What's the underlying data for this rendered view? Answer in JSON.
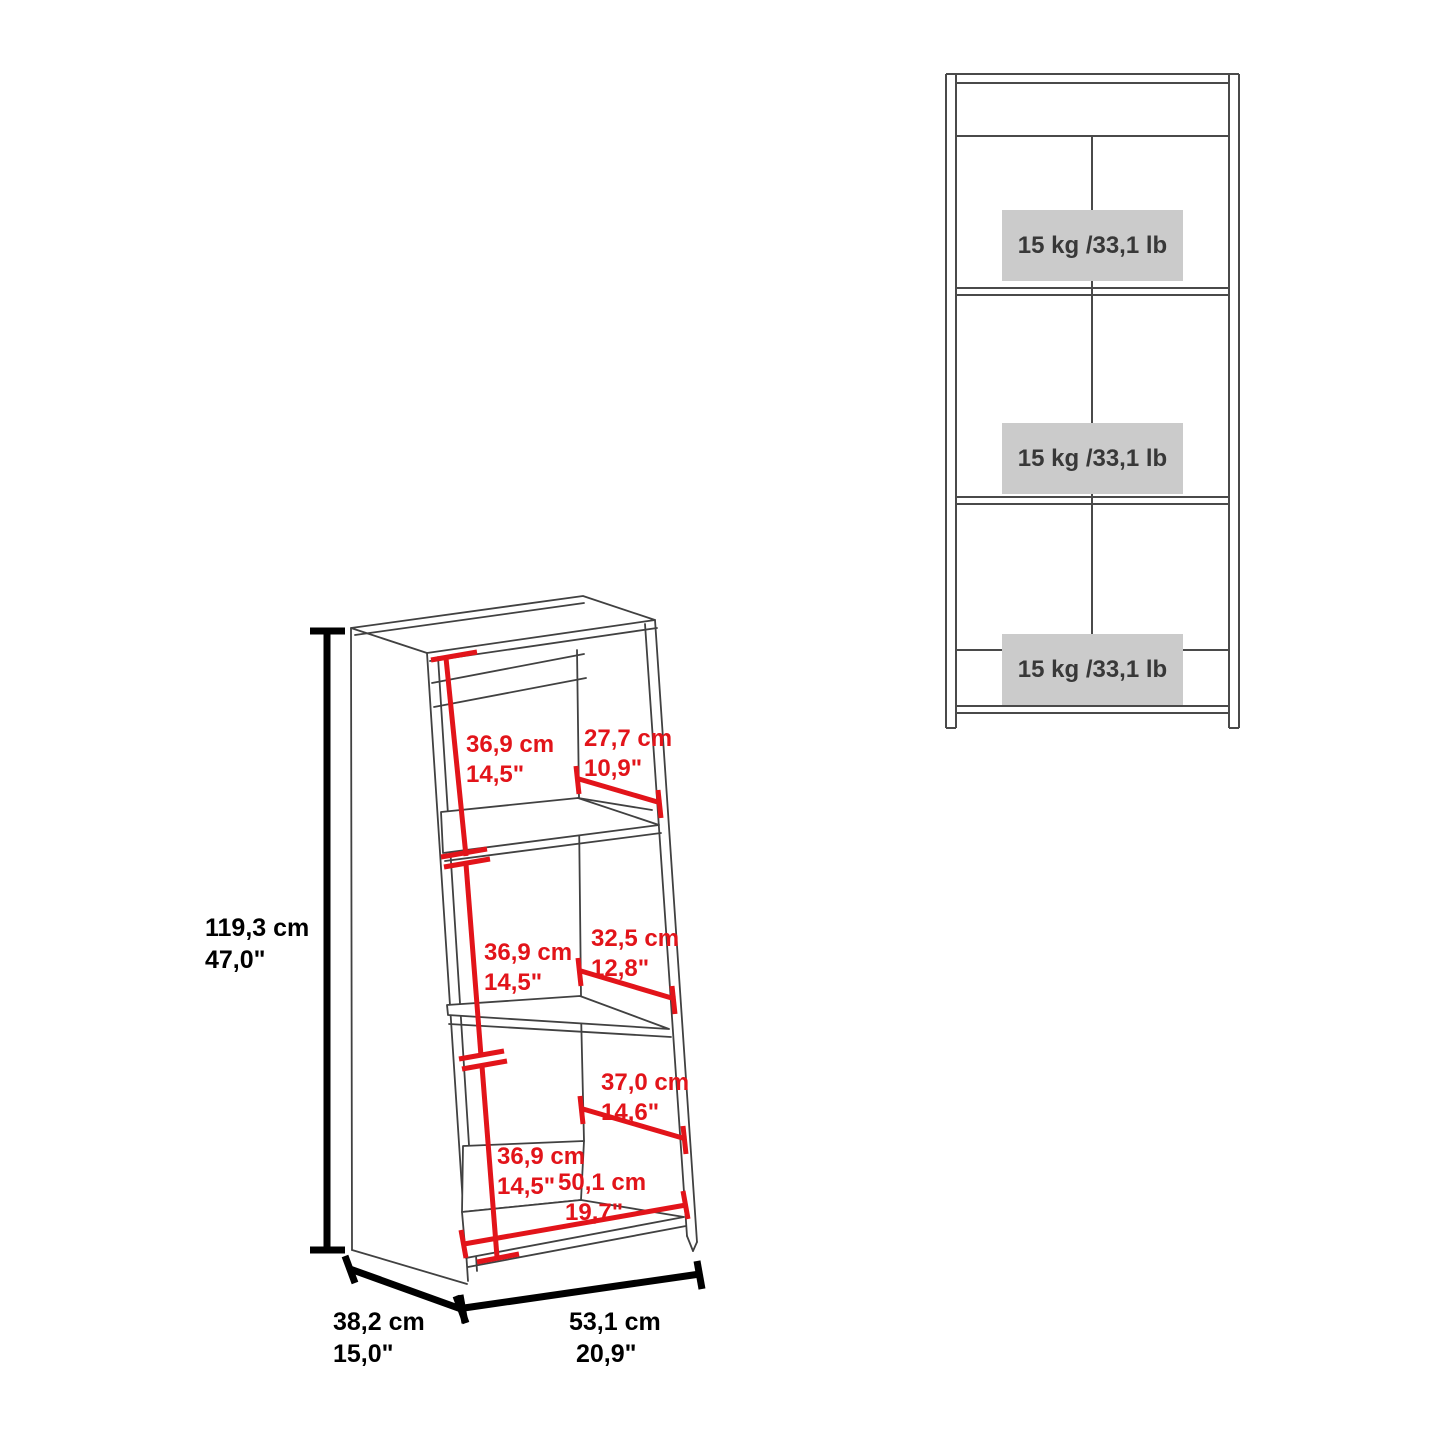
{
  "document": {
    "kind": "furniture-dimension-diagram",
    "product": "3-shelf leaning ladder bookcase"
  },
  "colors": {
    "dimension_red": "#e2141a",
    "dimension_black": "#000000",
    "drawing_line": "#414141",
    "capacity_box_bg": "#cbcbcb",
    "background": "#ffffff"
  },
  "dims": {
    "overall_height": {
      "cm": "119,3 cm",
      "inch": "47,0\""
    },
    "overall_depth": {
      "cm": "38,2 cm",
      "inch": "15,0\""
    },
    "overall_width": {
      "cm": "53,1 cm",
      "inch": "20,9\""
    },
    "shelf1_interior_height": {
      "cm": "36,9 cm",
      "inch": "14,5\""
    },
    "shelf1_depth": {
      "cm": "27,7 cm",
      "inch": "10,9\""
    },
    "shelf2_interior_height": {
      "cm": "36,9 cm",
      "inch": "14,5\""
    },
    "shelf2_depth": {
      "cm": "32,5 cm",
      "inch": "12,8\""
    },
    "shelf3_depth": {
      "cm": "37,0 cm",
      "inch": "14,6\""
    },
    "shelf3_interior_height": {
      "cm": "36,9 cm",
      "inch": "14,5\""
    },
    "interior_width": {
      "cm": "50,1 cm",
      "inch": "19,7\""
    }
  },
  "capacity": {
    "shelf1": "15 kg /33,1 lb",
    "shelf2": "15 kg /33,1 lb",
    "shelf3": "15 kg /33,1 lb"
  }
}
